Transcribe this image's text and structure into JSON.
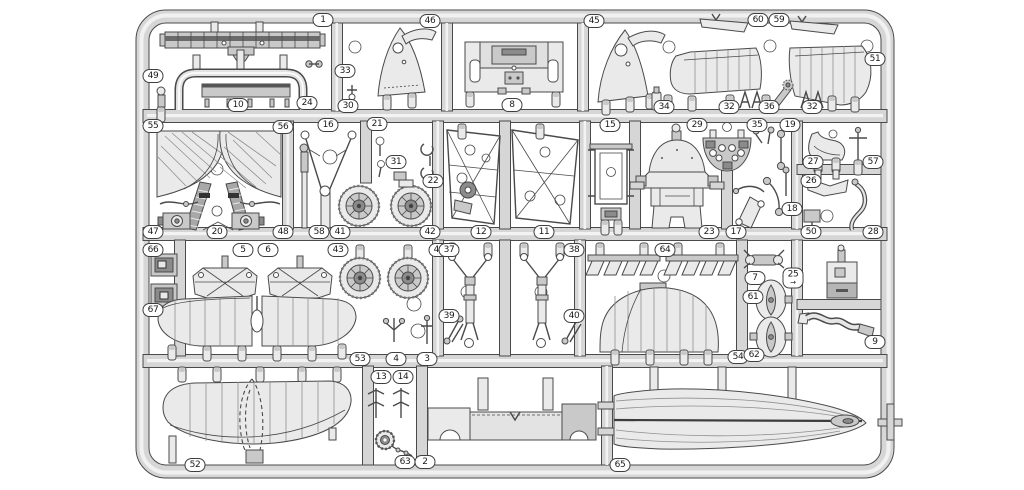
{
  "sprue": {
    "description": "Injection-molded model aircraft kit sprue runner frame with numbered parts",
    "colors": {
      "background": "#ffffff",
      "runner_fill": "#d6d6d6",
      "runner_highlight": "#f3f3f3",
      "outline": "#4a4a4a",
      "part_fill": "#eaeaea",
      "part_mid": "#c9c9c9",
      "part_dark": "#8b8b8b",
      "label_background": "#ffffff",
      "label_border": "#3f3f3f",
      "label_text": "#1a1a1a"
    },
    "labels": [
      {
        "n": "1",
        "x": 323,
        "y": 20
      },
      {
        "n": "46",
        "x": 430,
        "y": 21
      },
      {
        "n": "45",
        "x": 594,
        "y": 21
      },
      {
        "n": "60",
        "x": 758,
        "y": 20
      },
      {
        "n": "59",
        "x": 779,
        "y": 20
      },
      {
        "n": "49",
        "x": 153,
        "y": 76
      },
      {
        "n": "33",
        "x": 345,
        "y": 71
      },
      {
        "n": "51",
        "x": 875,
        "y": 59
      },
      {
        "n": "24",
        "x": 307,
        "y": 103
      },
      {
        "n": "10",
        "x": 238,
        "y": 105
      },
      {
        "n": "30",
        "x": 348,
        "y": 106
      },
      {
        "n": "8",
        "x": 512,
        "y": 105
      },
      {
        "n": "34",
        "x": 664,
        "y": 107
      },
      {
        "n": "32",
        "x": 729,
        "y": 107
      },
      {
        "n": "36",
        "x": 769,
        "y": 107
      },
      {
        "n": "32",
        "x": 812,
        "y": 107
      },
      {
        "n": "55",
        "x": 153,
        "y": 126
      },
      {
        "n": "56",
        "x": 283,
        "y": 127
      },
      {
        "n": "16",
        "x": 328,
        "y": 125
      },
      {
        "n": "21",
        "x": 377,
        "y": 124
      },
      {
        "n": "15",
        "x": 610,
        "y": 125
      },
      {
        "n": "29",
        "x": 697,
        "y": 125
      },
      {
        "n": "35",
        "x": 757,
        "y": 125
      },
      {
        "n": "19",
        "x": 790,
        "y": 125
      },
      {
        "n": "31",
        "x": 396,
        "y": 162
      },
      {
        "n": "27",
        "x": 813,
        "y": 162
      },
      {
        "n": "57",
        "x": 873,
        "y": 162
      },
      {
        "n": "22",
        "x": 433,
        "y": 181
      },
      {
        "n": "26",
        "x": 811,
        "y": 181
      },
      {
        "n": "18",
        "x": 792,
        "y": 209
      },
      {
        "n": "47",
        "x": 153,
        "y": 232
      },
      {
        "n": "20",
        "x": 217,
        "y": 232
      },
      {
        "n": "48",
        "x": 283,
        "y": 232
      },
      {
        "n": "58",
        "x": 319,
        "y": 232
      },
      {
        "n": "41",
        "x": 340,
        "y": 232
      },
      {
        "n": "42",
        "x": 430,
        "y": 232
      },
      {
        "n": "12",
        "x": 481,
        "y": 232
      },
      {
        "n": "11",
        "x": 544,
        "y": 232
      },
      {
        "n": "23",
        "x": 709,
        "y": 232
      },
      {
        "n": "17",
        "x": 736,
        "y": 232
      },
      {
        "n": "50",
        "x": 811,
        "y": 232
      },
      {
        "n": "28",
        "x": 873,
        "y": 232
      },
      {
        "n": "66",
        "x": 153,
        "y": 250
      },
      {
        "n": "5",
        "x": 243,
        "y": 250
      },
      {
        "n": "6",
        "x": 268,
        "y": 250
      },
      {
        "n": "43",
        "x": 338,
        "y": 250
      },
      {
        "n": "44",
        "x": 439,
        "y": 250
      },
      {
        "n": "37",
        "x": 449,
        "y": 250
      },
      {
        "n": "38",
        "x": 574,
        "y": 250
      },
      {
        "n": "64",
        "x": 665,
        "y": 250
      },
      {
        "n": "7",
        "x": 755,
        "y": 278
      },
      {
        "n": "25",
        "x": 793,
        "y": 278,
        "sub": "→"
      },
      {
        "n": "61",
        "x": 753,
        "y": 297
      },
      {
        "n": "67",
        "x": 153,
        "y": 310
      },
      {
        "n": "39",
        "x": 449,
        "y": 316
      },
      {
        "n": "40",
        "x": 574,
        "y": 316
      },
      {
        "n": "9",
        "x": 875,
        "y": 342
      },
      {
        "n": "53",
        "x": 360,
        "y": 359
      },
      {
        "n": "4",
        "x": 396,
        "y": 359
      },
      {
        "n": "3",
        "x": 427,
        "y": 359
      },
      {
        "n": "54",
        "x": 738,
        "y": 357
      },
      {
        "n": "62",
        "x": 754,
        "y": 355
      },
      {
        "n": "13",
        "x": 381,
        "y": 377
      },
      {
        "n": "14",
        "x": 403,
        "y": 377
      },
      {
        "n": "52",
        "x": 195,
        "y": 465
      },
      {
        "n": "63",
        "x": 405,
        "y": 462
      },
      {
        "n": "2",
        "x": 425,
        "y": 462
      },
      {
        "n": "65",
        "x": 620,
        "y": 465
      }
    ]
  }
}
